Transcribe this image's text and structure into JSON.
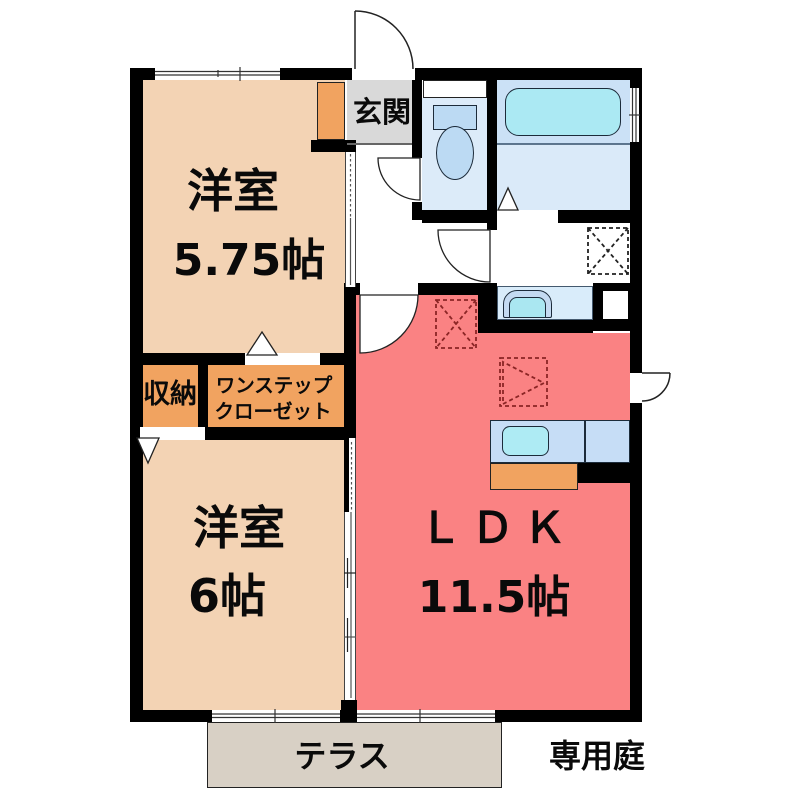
{
  "floorplan": {
    "title": "2LDK apartment floor plan",
    "rooms": {
      "bedroom1": {
        "name": "洋室",
        "size": "5.75帖"
      },
      "bedroom2": {
        "name": "洋室",
        "size": "6帖"
      },
      "ldk": {
        "name": "ＬＤＫ",
        "size": "11.5帖"
      },
      "entrance": {
        "label": "玄関"
      },
      "storage": {
        "label": "収納"
      },
      "closet": {
        "line1": "ワンステップ",
        "line2": "クローゼット"
      }
    },
    "outdoor": {
      "terrace": "テラス",
      "garden": "専用庭"
    },
    "symbols": [
      "entrance-door-arc",
      "toilet-door-arc",
      "washroom-door-arc",
      "ldk-door-arc",
      "garden-door-arc",
      "refrigerator-space-dashed-box",
      "washing-machine-space-dashed-box",
      "appliance-space-dashed-triangle-box",
      "folding-door-triangle",
      "sliding-door-track",
      "window-double-line"
    ],
    "colors": {
      "wall": "#000000",
      "bedroom": "#F3D3B4",
      "ldk": "#FA8283",
      "cabinet_orange": "#F1A360",
      "entrance_gray": "#D9D9D9",
      "terrace": "#D8D0C5",
      "toilet_room": "#DCEBF9",
      "bath_upper": "#CBE1F6",
      "bath_lower": "#DAEAF9",
      "bathtub": "#ABE9F3",
      "kitchen_counter": "#C6DDF6",
      "sink": "#AEEBF4",
      "dashed_symbol_red": "#8B2525"
    }
  }
}
